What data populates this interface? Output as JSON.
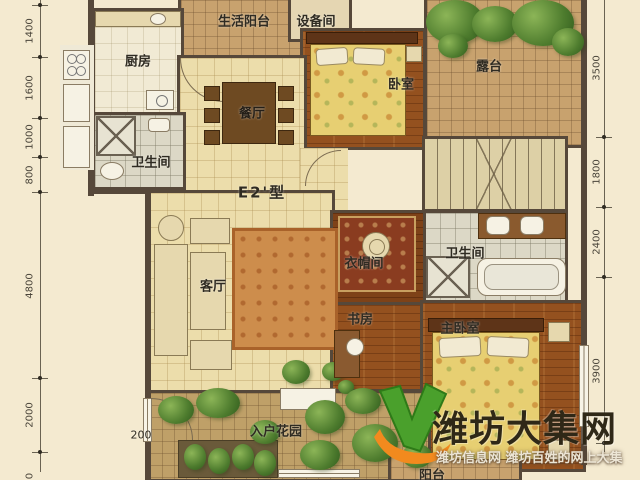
{
  "plan": {
    "type_label": "E2'型"
  },
  "rooms": {
    "living_balcony": {
      "label": "生活阳台"
    },
    "equipment": {
      "label": "设备间"
    },
    "kitchen": {
      "label": "厨房"
    },
    "bedroom2": {
      "label": "卧室"
    },
    "terrace": {
      "label": "露台"
    },
    "dining": {
      "label": "餐厅"
    },
    "bath1": {
      "label": "卫生间"
    },
    "living": {
      "label": "客厅"
    },
    "cloakroom": {
      "label": "衣帽间"
    },
    "bath2": {
      "label": "卫生间"
    },
    "study": {
      "label": "书房"
    },
    "master_bedroom": {
      "label": "主卧室"
    },
    "entry_garden": {
      "label": "入户花园"
    },
    "balcony": {
      "label": "阳台"
    }
  },
  "dimensions": {
    "left": [
      "1400",
      "1600",
      "1000",
      "800",
      "4800",
      "2000",
      "0"
    ],
    "right": [
      "3500",
      "1800",
      "2400",
      "3900"
    ],
    "entry": "200"
  },
  "watermark": {
    "brand": "潍坊大集网",
    "tagline": "潍坊信息网 潍坊百姓的网上大集",
    "colors": {
      "leaf": "#4aa02c",
      "swoosh": "#f28a1e",
      "text": "#2f2817"
    }
  }
}
